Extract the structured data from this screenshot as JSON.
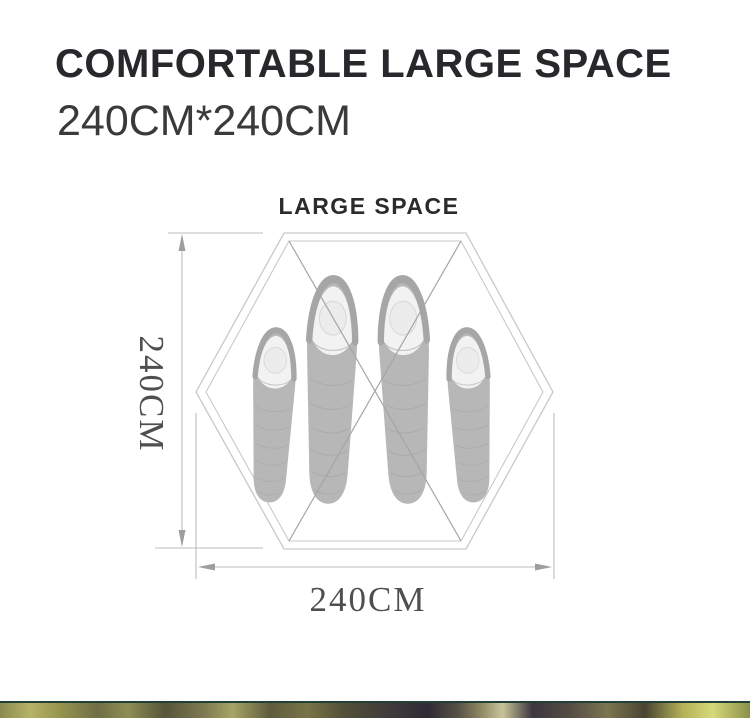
{
  "header": {
    "title": "COMFORTABLE LARGE SPACE",
    "subtitle": "240CM*240CM"
  },
  "diagram": {
    "title": "LARGE SPACE",
    "height_dimension": "240CM",
    "width_dimension": "240CM",
    "floor_shape": "hexagon",
    "sleeping_bag_count": 4,
    "colors": {
      "outline": "#c9c9c9",
      "cross_lines": "#a5a5a5",
      "dimension_lines": "#bdbdbd",
      "arrowheads": "#9e9e9e",
      "bag_body": "#b7b7b7",
      "bag_hood": "#a6a6a6",
      "bag_pillow": "#f2f2f2",
      "bag_circle": "#ececec",
      "label_text": "#4f4f4f"
    }
  }
}
